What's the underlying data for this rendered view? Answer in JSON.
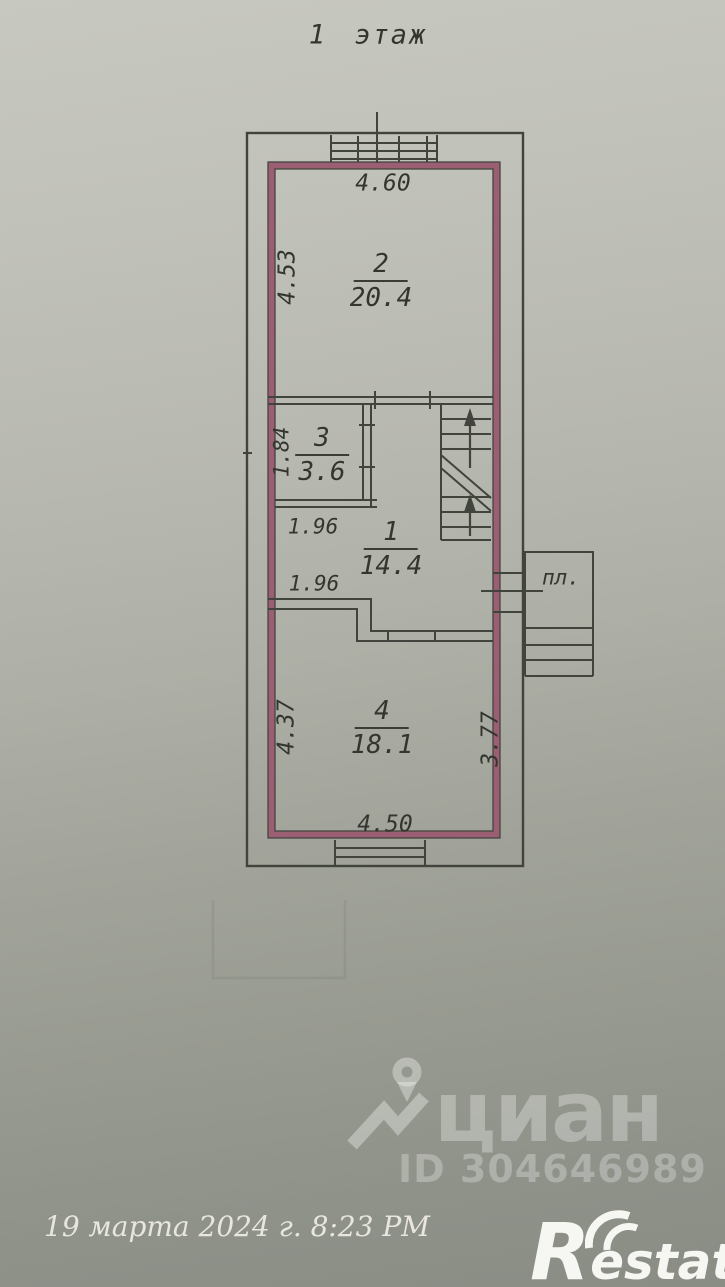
{
  "title": "1 этаж",
  "plan": {
    "rooms": [
      {
        "number": "2",
        "area": "20.4"
      },
      {
        "number": "3",
        "area": "3.6"
      },
      {
        "number": "1",
        "area": "14.4"
      },
      {
        "number": "4",
        "area": "18.1"
      }
    ],
    "dims": {
      "top_width": "4.60",
      "room2_height": "4.53",
      "room3_height": "1.84",
      "room3_width": "1.96",
      "niche_width": "1.96",
      "room4_height_left": "4.37",
      "room4_height_right": "3.77",
      "room4_width": "4.50"
    },
    "porch_label": "пл."
  },
  "watermark": {
    "brand": "циан",
    "listing_id": "ID 304646989"
  },
  "footer": {
    "date": "19 марта 2024 г. 8:23 PM",
    "agency": "Restate"
  },
  "colors": {
    "wall_accent": "#9c5e73",
    "ink": "#41443c",
    "paper_top": "#c7c8c0",
    "paper_bottom": "#898d84"
  }
}
